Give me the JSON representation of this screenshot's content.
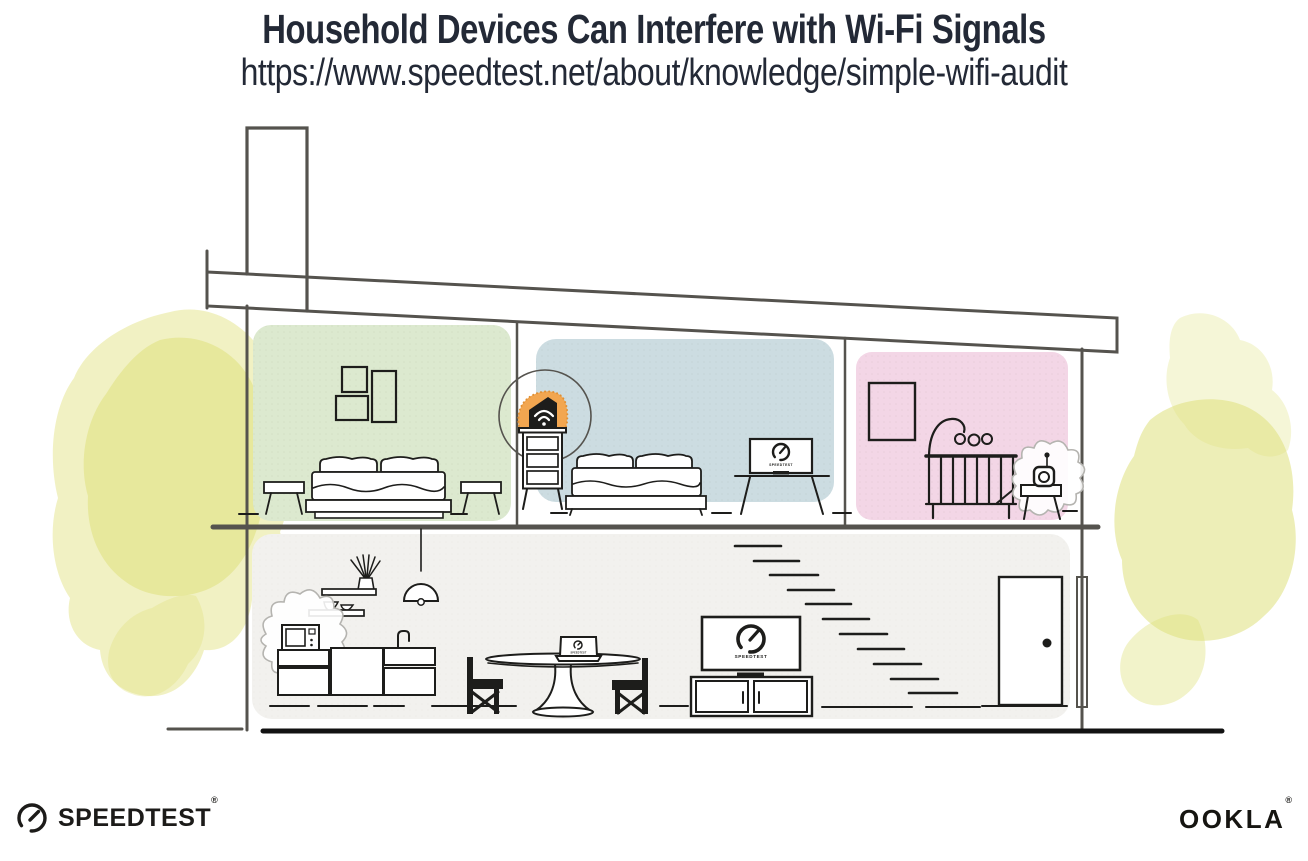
{
  "header": {
    "title": "Household Devices Can Interfere with Wi-Fi Signals",
    "url": "https://www.speedtest.net/about/knowledge/simple-wifi-audit"
  },
  "screens": {
    "living_room_tv_label": "SPEEDTEST",
    "bedroom_tv_label": "SPEEDTEST",
    "laptop_label": "SPEEDTEST"
  },
  "branding": {
    "speedtest_wordmark": "SPEEDTEST",
    "speedtest_trademark": "®",
    "ookla_wordmark": "OOKLA",
    "ookla_trademark": "®"
  },
  "icons": {
    "router": "wifi-icon",
    "speedtest": "gauge-icon"
  },
  "colors": {
    "title": "#232936",
    "structure": "#55534e",
    "furniture": "#1d1d1b",
    "green": "#dce9cf",
    "blue": "#ccdce1",
    "pink": "#f3d6e6",
    "floor": "#f2f1ee",
    "orange": "#f2a650",
    "yellow": "#dfe07b",
    "ground": "#121212",
    "burst": "#b5b4b0"
  }
}
